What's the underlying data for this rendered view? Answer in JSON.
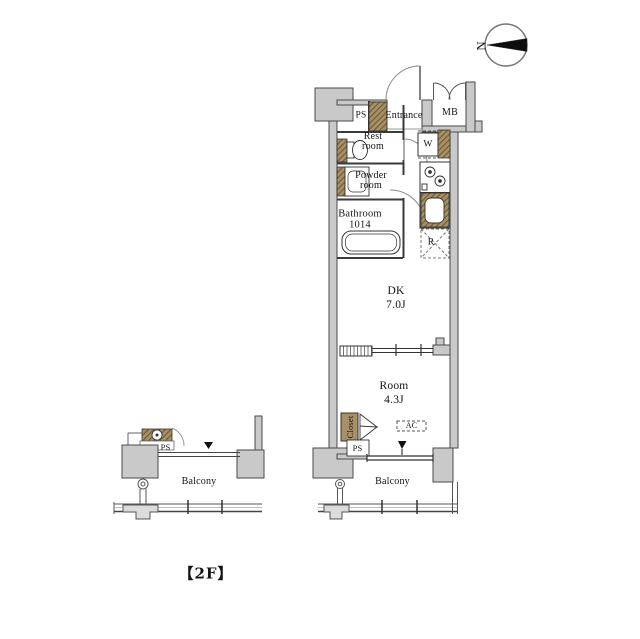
{
  "compass": {
    "north": "N"
  },
  "floor_label": "【2F】",
  "unit": {
    "ps_top": "PS",
    "entrance": "Entrance",
    "meter_box": "MB",
    "rest_room": [
      "Rest",
      "room"
    ],
    "washer": "W",
    "powder_room": [
      "Powder",
      "room"
    ],
    "bathroom": [
      "Bathroom",
      "1014"
    ],
    "refrigerator": "R",
    "dk": [
      "DK",
      "7.0J"
    ],
    "room": [
      "Room",
      "4.3J"
    ],
    "closet": "Closet",
    "ac": "AC",
    "ps_bottom": "PS",
    "balcony": "Balcony"
  },
  "adjacent_unit": {
    "ps": "PS",
    "balcony": "Balcony"
  },
  "colors": {
    "wall_fill": "#c9c9c9",
    "wall_stroke": "#4a4a4a",
    "wood_tan": "#a89064",
    "line": "#3a3a3a",
    "background": "#ffffff"
  }
}
